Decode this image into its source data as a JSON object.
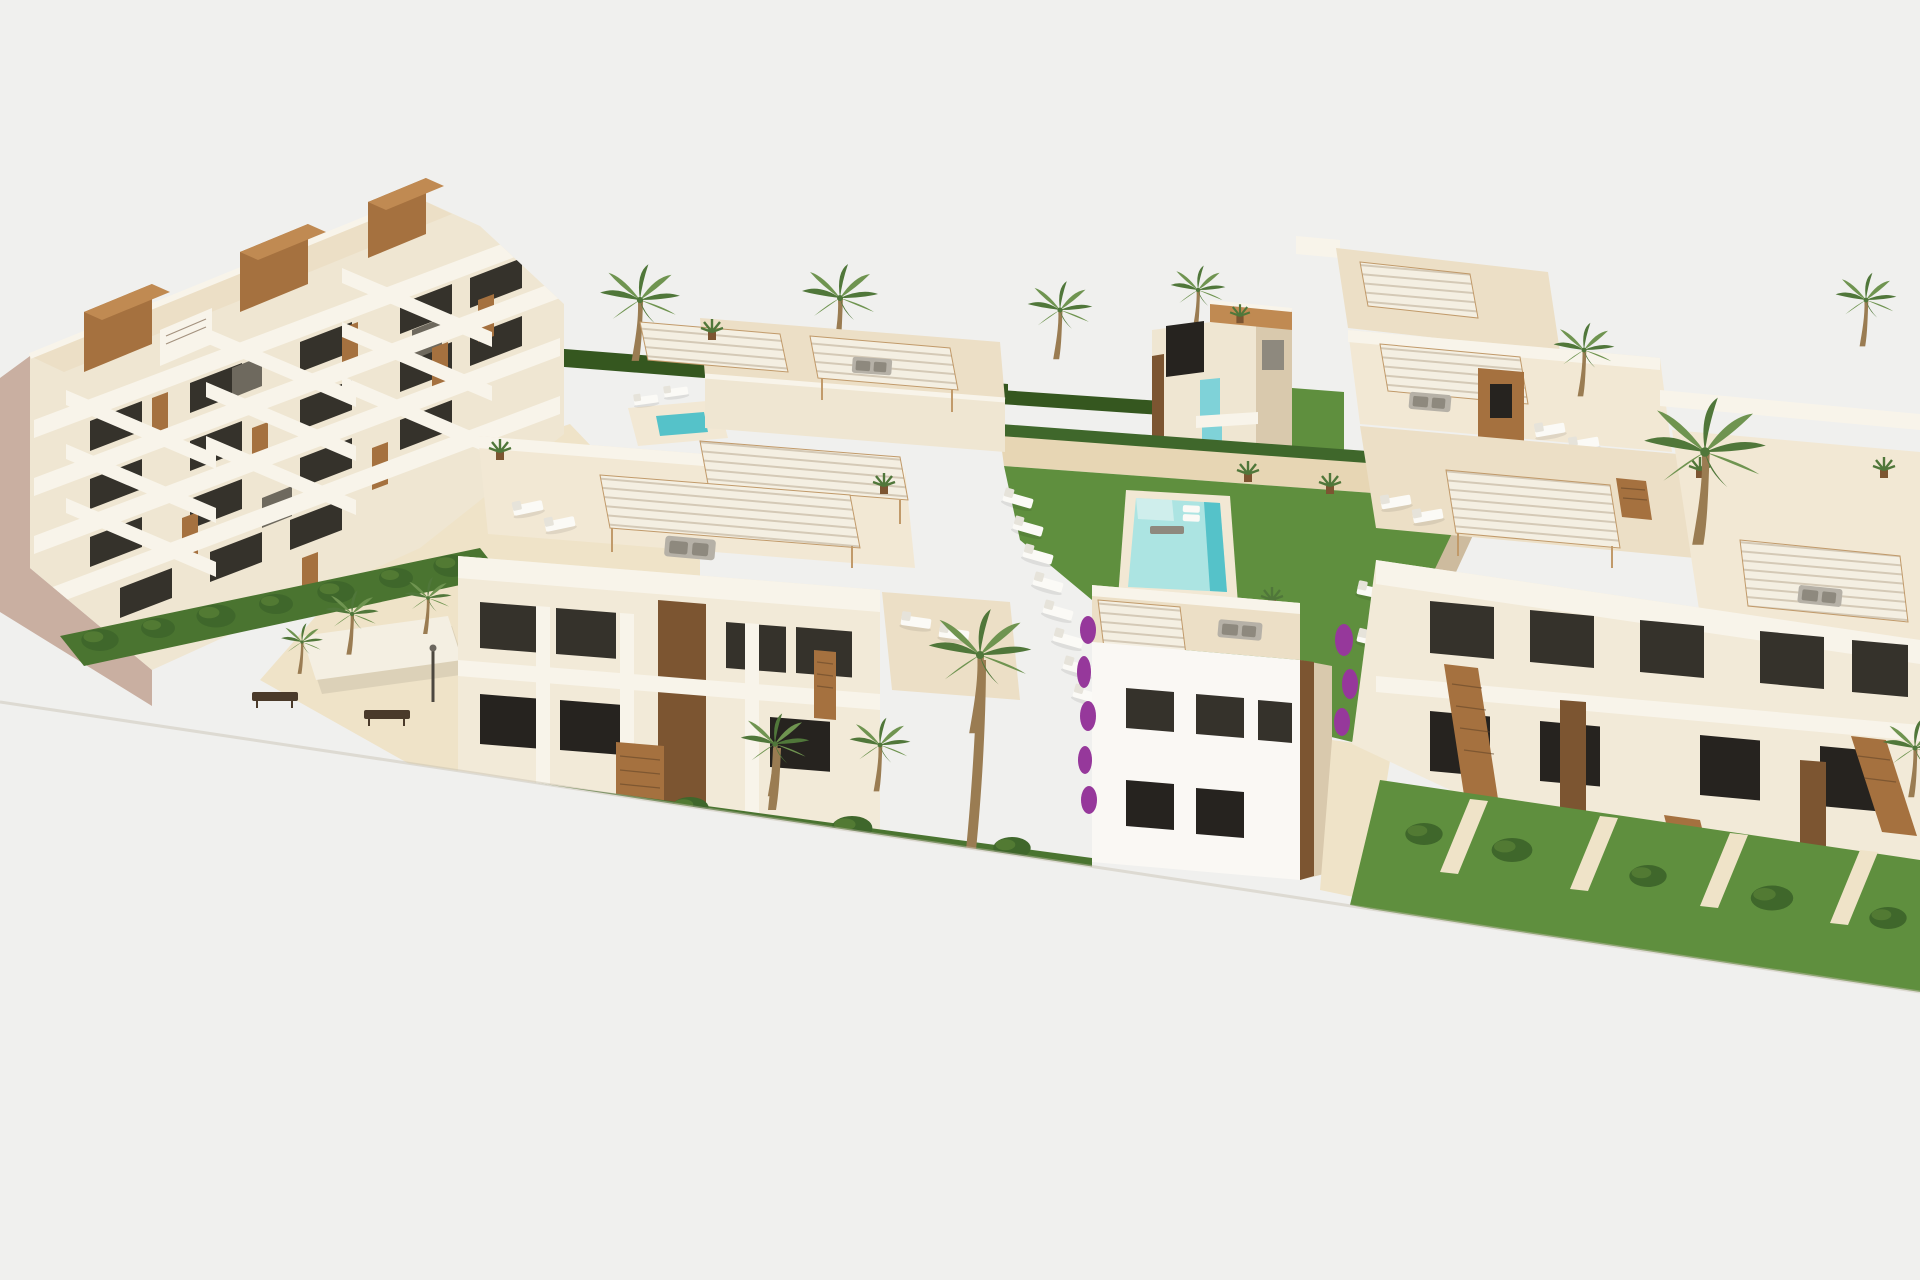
{
  "scene": {
    "title": "New-build residential complex — aerial 3D render",
    "description": "Aerial CGI rendering of a modern Mediterranean residential development: a stepped five-storey apartment block with zig-zag terraces on the left, rows of two-storey cream apartments with rooftop terraces shaded by slatted pergolas, a communal lawn with a turquoise swimming pool lined with white sun loungers, a small pool pavilion with turquoise glass balconies, sandy walkways with benches and a shade sail, wooden outdoor staircases, hedges, bougainvillea and palm trees, all cut off diagonally on a plain white studio background.",
    "view": "three-quarter aerial view, content cropped by a diagonal white foreground",
    "colors": {
      "background": "#f0f0ee",
      "wall_sun": "#f2ead8",
      "wall_light": "#efe6d2",
      "wall_shade": "#d9c9ad",
      "wall_taupe": "#cdbb9e",
      "gable": "#c9afa1",
      "deck": "#ecdfc6",
      "deck_light": "#f2e8d4",
      "parapet": "#f8f4ea",
      "pergola": "#f4efe2",
      "pergola_frame": "#c19a6a",
      "wood": "#a5713f",
      "wood_light": "#c08a52",
      "wood_dark": "#7c5531",
      "window_dark": "#35322b",
      "window_deep": "#26231f",
      "glass": "#6e695e",
      "glass_teal": "#7fd2d8",
      "pool_light": "#ace4e2",
      "pool_deep": "#55c2c9",
      "pool_shelf": "#cfeeec",
      "grass": "#5f8f3e",
      "grass_shade": "#4a7430",
      "hedge": "#3f672b",
      "hedge_hi": "#527a33",
      "hedge_dark": "#35571f",
      "palm_light": "#6f9450",
      "palm_dark": "#50773a",
      "trunk": "#9a7c52",
      "sand": "#e7d6b4",
      "sand_light": "#efe3c8",
      "lounger": "#fbfaf6",
      "lounger_shade": "#e6e3da",
      "furn_gray": "#b6b1a7",
      "furn_gray_dark": "#8e897e",
      "bench": "#4a3a2a",
      "purple": "#96389b",
      "edge_shadow": "#c5beb0"
    },
    "inventory": {
      "apartment_buildings": 5,
      "pool_pavilions": 1,
      "swimming_pools": 2,
      "rooftop_pergolas": 8,
      "palm_trees": 14,
      "sun_loungers": 26,
      "outdoor_sofas": 6,
      "park_benches": 2,
      "shade_sails": 1,
      "wooden_staircases": 6,
      "street_lamps": 2
    }
  }
}
